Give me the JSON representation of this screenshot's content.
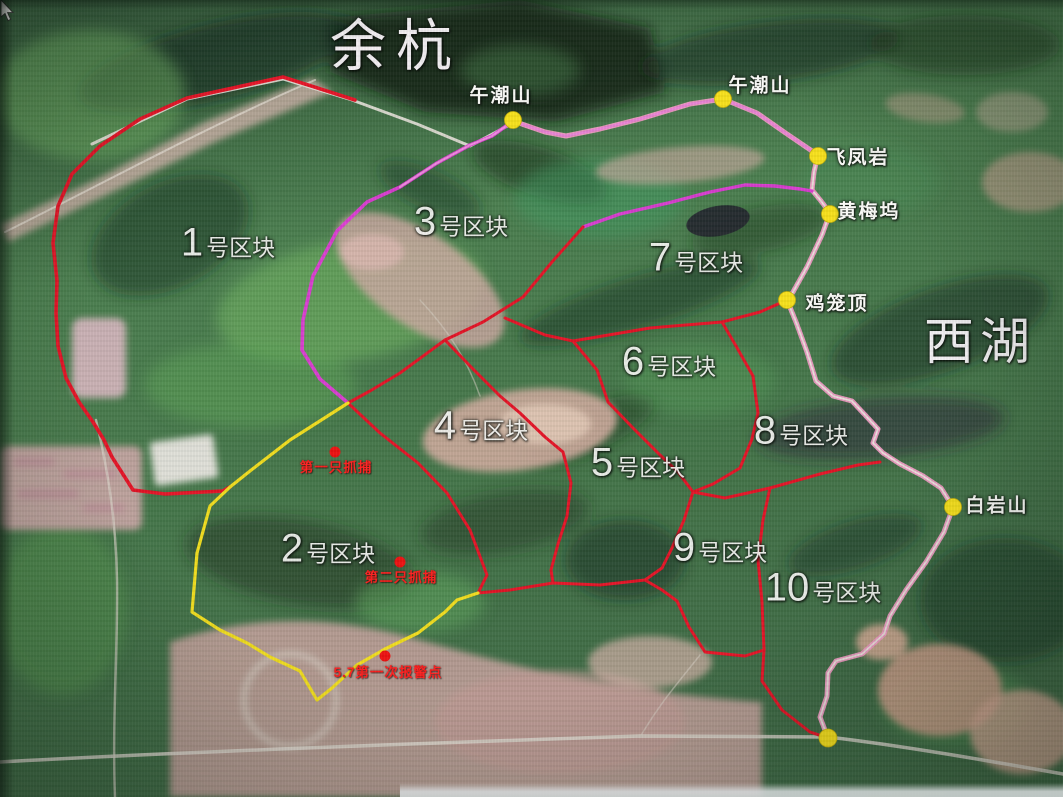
{
  "map": {
    "region_labels": [
      {
        "text": "余杭"
      },
      {
        "text": "西湖"
      }
    ],
    "zones": [
      {
        "number": "1",
        "suffix": "号区块"
      },
      {
        "number": "2",
        "suffix": "号区块"
      },
      {
        "number": "3",
        "suffix": "号区块"
      },
      {
        "number": "4",
        "suffix": "号区块"
      },
      {
        "number": "5",
        "suffix": "号区块"
      },
      {
        "number": "6",
        "suffix": "号区块"
      },
      {
        "number": "7",
        "suffix": "号区块"
      },
      {
        "number": "8",
        "suffix": "号区块"
      },
      {
        "number": "9",
        "suffix": "号区块"
      },
      {
        "number": "10",
        "suffix": "号区块"
      }
    ],
    "waypoints": [
      {
        "name": "午潮山"
      },
      {
        "name": "午潮山"
      },
      {
        "name": "飞凤岩"
      },
      {
        "name": "黄梅坞"
      },
      {
        "name": "鸡笼顶"
      },
      {
        "name": "白岩山"
      }
    ],
    "incident_markers": [
      {
        "label": "第一只抓捕"
      },
      {
        "label": "第二只抓捕"
      },
      {
        "label": "5.7第一次报警点"
      }
    ],
    "colors": {
      "zone_boundary_red": "#e51427",
      "search_zone2_yellow": "#f2de1f",
      "track_pink": "#f09cc4",
      "track_magenta": "#e23ad8",
      "waypoint_dot_yellow": "#f8e11c",
      "incident_dot_red": "#ee1111",
      "label_white": "#f6f6f4",
      "incident_text_red": "#ff1f1f"
    }
  }
}
